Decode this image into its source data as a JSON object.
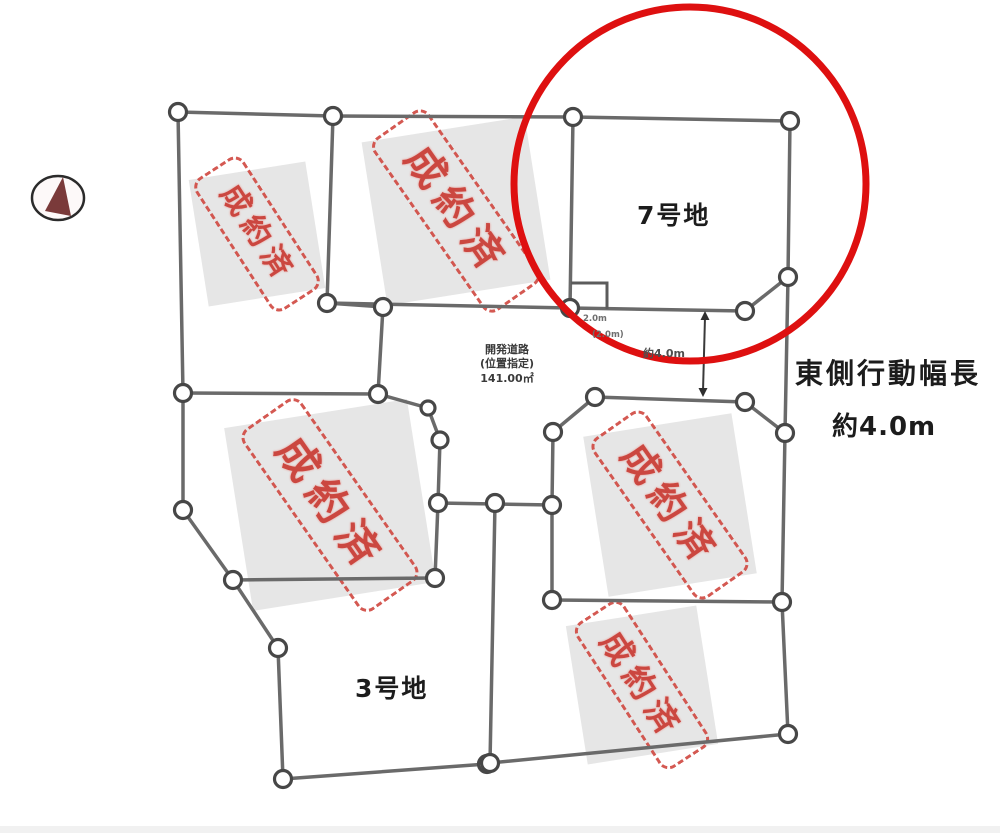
{
  "diagram": {
    "type": "land-subdivision-plot-map",
    "plots": {
      "plot7_label": "7号地",
      "plot3_label": "3号地"
    },
    "sold_stamp_label": "成約済",
    "sold_stamp_count": 5,
    "east_note": {
      "line1": "東側行動幅長",
      "line2": "約4.0m"
    },
    "road_note": {
      "line1": "開発道路",
      "line2": "(位置指定)",
      "line3": "141.00㎡"
    },
    "gap_dimension_label": "約4.0m",
    "notch_dimension": {
      "line1": "2.0m",
      "line2": "(2.0m)"
    },
    "icons": {
      "compass": "north-arrow-compass-icon"
    },
    "colors": {
      "highlight_circle": "#de1010",
      "stamp_red": "#c93a33",
      "stamp_bg_gray": "#e6e6e6",
      "boundary_gray": "#6a6a6a",
      "compass_maroon": "#7a3a3a"
    }
  }
}
